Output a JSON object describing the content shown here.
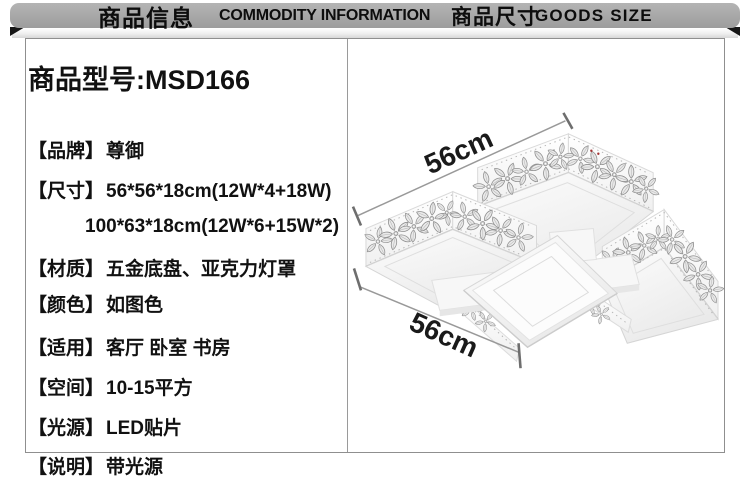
{
  "header": {
    "left_zh": "商品信息",
    "left_en": "COMMODITY INFORMATION",
    "right_zh": "商品尺寸",
    "right_en": "GOODS SIZE"
  },
  "product": {
    "model_title": "商品型号:MSD166",
    "specs": [
      {
        "label": "【品牌】",
        "value": "尊御"
      },
      {
        "label": "【尺寸】",
        "value": "56*56*18cm(12W*4+18W)",
        "value_line2": "100*63*18cm(12W*6+15W*2)"
      },
      {
        "label": "【材质】",
        "value": "五金底盘、亚克力灯罩"
      },
      {
        "label": "【颜色】",
        "value": "如图色"
      },
      {
        "label": "【适用】",
        "value": "客厅 卧室 书房"
      },
      {
        "label": "【空间】",
        "value": "10-15平方"
      },
      {
        "label": "【光源】",
        "value": "LED贴片"
      },
      {
        "label": "【说明】",
        "value": "带光源"
      }
    ]
  },
  "size_diagram": {
    "top_label": "56cm",
    "bottom_label": "56cm"
  },
  "colors": {
    "header_bar": "#a9a9a9",
    "box_border": "#8f8f8f",
    "text": "#111111",
    "dimension_line": "#999999",
    "lamp_body": "#ffffff",
    "flower_decoration": "#bdbdbd"
  }
}
